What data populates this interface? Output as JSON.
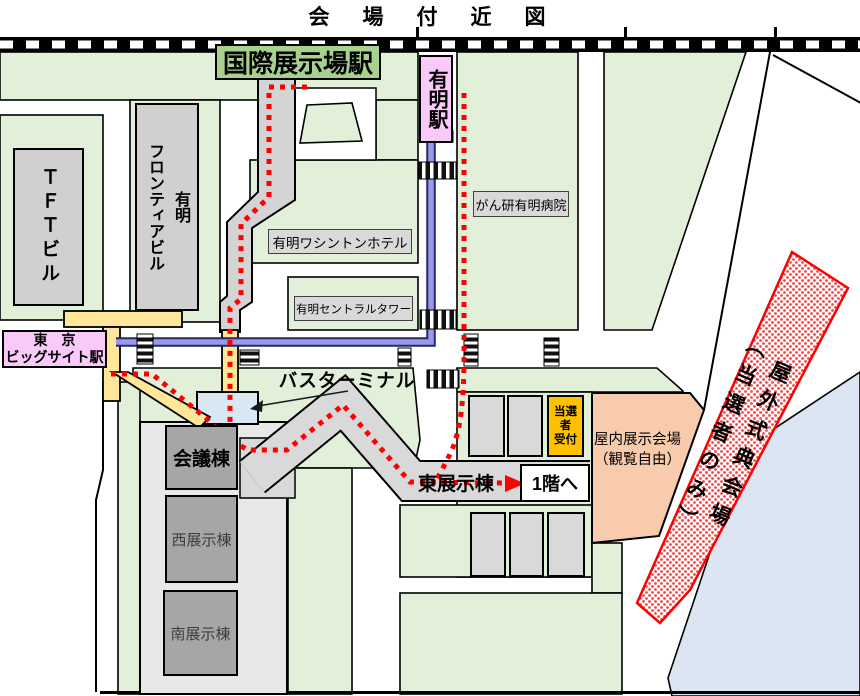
{
  "title": "会　場　付　近　図",
  "stations": {
    "kokusai_tenjijo": "国際展示場駅",
    "ariake": "有明駅",
    "big_sight_line1": "東　京",
    "big_sight_line2": "ビッグサイト駅"
  },
  "buildings": {
    "tft": "ＴＦＴビル",
    "frontier": "有明\nフロンティアビル",
    "washington_hotel": "有明ワシントンホテル",
    "central_tower": "有明セントラルタワー",
    "hospital": "がん研有明病院",
    "conference": "会議棟",
    "west_hall": "西展示棟",
    "south_hall": "南展示棟",
    "east_hall": "東展示棟"
  },
  "labels": {
    "bus_terminal": "バスターミナル",
    "to_first_floor": "1階へ",
    "winner_reception_line1": "当選者",
    "winner_reception_line2": "受付",
    "indoor_venue_line1": "屋内展示会場",
    "indoor_venue_line2": "（観覧自由）",
    "outdoor_venue": "屋外式典会場\n（当選者のみ）"
  },
  "colors": {
    "area_green": "#e2efd9",
    "station_green": "#a9d18e",
    "station_pink": "#f9c9f9",
    "deck_yellow": "#ffe699",
    "walkway_gray": "#d4d4d4",
    "building_gray": "#d2cfcf",
    "hall_dark_gray": "#a6a6a6",
    "reception_orange": "#ffc000",
    "indoor_peach": "#f8cbad",
    "route_red": "#ff0000",
    "line_blue": "#9a9ae6",
    "water_blue": "#dce6f2"
  }
}
